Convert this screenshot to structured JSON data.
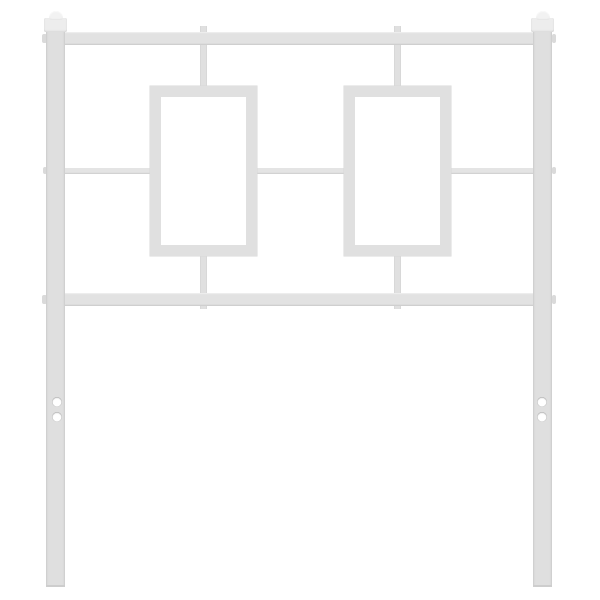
{
  "meta": {
    "description": "White metal bed headboard with two vertical posts topped by square finials, a top and bottom horizontal rail, two rectangular frame ornaments linked by a thin center crossbar and vertical stubs, and legs with two mounting holes each, photographed on a plain white background"
  },
  "scene": {
    "canvas": {
      "width": 600,
      "height": 600,
      "background": "#ffffff"
    },
    "palette": {
      "post": "#dfdfdf",
      "rail": "#e2e2e2",
      "crossbar": "#e4e4e4",
      "rect-frame": "#e0e0e0",
      "stub": "#e0e0e0",
      "nub": "#dadada",
      "tick": "#d2d2d2",
      "cap-block": "#ededed",
      "cap-dome": "#f2f2f2",
      "hole": "#ffffff",
      "edge": "#cdcdcd"
    },
    "parts": [
      {
        "name": "stub-top-left",
        "type": "stub",
        "x": 200,
        "y": 26,
        "w": 7,
        "h": 64
      },
      {
        "name": "stub-top-right",
        "type": "stub",
        "x": 394,
        "y": 26,
        "w": 7,
        "h": 64
      },
      {
        "name": "stub-bottom-left",
        "type": "stub",
        "x": 200,
        "y": 252,
        "w": 7,
        "h": 57
      },
      {
        "name": "stub-bottom-right",
        "type": "stub",
        "x": 394,
        "y": 252,
        "w": 7,
        "h": 57
      },
      {
        "name": "weld-tick-left-frame-inner-left",
        "type": "tick",
        "x": 160.5,
        "y": 167,
        "w": 3,
        "h": 7.5
      },
      {
        "name": "weld-tick-left-frame-inner-right",
        "type": "tick",
        "x": 242.5,
        "y": 167,
        "w": 3,
        "h": 7.5
      },
      {
        "name": "weld-tick-right-frame-inner-left",
        "type": "tick",
        "x": 354.5,
        "y": 167,
        "w": 3,
        "h": 7.5
      },
      {
        "name": "weld-tick-right-frame-inner-right",
        "type": "tick",
        "x": 436.5,
        "y": 167,
        "w": 3,
        "h": 7.5
      },
      {
        "name": "nub-left-post-top-rail",
        "type": "nub",
        "x": 42,
        "y": 34,
        "w": 4.5,
        "h": 9
      },
      {
        "name": "nub-left-post-crossbar",
        "type": "nub",
        "x": 42.5,
        "y": 166.5,
        "w": 4,
        "h": 7.5
      },
      {
        "name": "nub-left-post-bottom-rail",
        "type": "nub",
        "x": 42,
        "y": 295,
        "w": 4.5,
        "h": 9
      },
      {
        "name": "nub-right-post-top-rail",
        "type": "nub",
        "x": 551.5,
        "y": 34,
        "w": 4.5,
        "h": 9
      },
      {
        "name": "nub-right-post-crossbar",
        "type": "nub",
        "x": 552,
        "y": 166.5,
        "w": 4,
        "h": 7.5
      },
      {
        "name": "nub-right-post-bottom-rail",
        "type": "nub",
        "x": 551.5,
        "y": 295,
        "w": 4.5,
        "h": 9
      },
      {
        "name": "crossbar-left-segment",
        "type": "crossbar",
        "x": 62,
        "y": 167.5,
        "w": 92,
        "h": 6
      },
      {
        "name": "crossbar-middle-segment",
        "type": "crossbar",
        "x": 253,
        "y": 167.5,
        "w": 94,
        "h": 6
      },
      {
        "name": "crossbar-right-segment",
        "type": "crossbar",
        "x": 447,
        "y": 167.5,
        "w": 92,
        "h": 6
      },
      {
        "name": "left-ornament-frame",
        "type": "rect-frame",
        "x": 150,
        "y": 86,
        "w": 107,
        "h": 170
      },
      {
        "name": "right-ornament-frame",
        "type": "rect-frame",
        "x": 344,
        "y": 86,
        "w": 107,
        "h": 170
      },
      {
        "name": "top-rail",
        "type": "rail",
        "x": 58,
        "y": 32,
        "w": 484,
        "h": 13
      },
      {
        "name": "bottom-rail",
        "type": "rail",
        "x": 58,
        "y": 293,
        "w": 484,
        "h": 13
      },
      {
        "name": "left-post",
        "type": "post",
        "x": 46,
        "y": 28,
        "w": 19,
        "h": 559
      },
      {
        "name": "right-post",
        "type": "post",
        "x": 533,
        "y": 28,
        "w": 19,
        "h": 559
      },
      {
        "name": "left-leg-bottom-edge",
        "type": "edge",
        "x": 46,
        "y": 585,
        "w": 19,
        "h": 2
      },
      {
        "name": "right-leg-bottom-edge",
        "type": "edge",
        "x": 533,
        "y": 585,
        "w": 19,
        "h": 2
      },
      {
        "name": "left-finial-block",
        "type": "cap-block",
        "x": 44,
        "y": 18,
        "w": 23,
        "h": 14
      },
      {
        "name": "left-finial-dome",
        "type": "cap-dome",
        "x": 48.5,
        "y": 11,
        "w": 14,
        "h": 9
      },
      {
        "name": "right-finial-block",
        "type": "cap-block",
        "x": 531,
        "y": 18,
        "w": 23,
        "h": 14
      },
      {
        "name": "right-finial-dome",
        "type": "cap-dome",
        "x": 535.5,
        "y": 11,
        "w": 14,
        "h": 9
      },
      {
        "name": "mounting-hole-left-leg-upper",
        "type": "hole",
        "x": 51.5,
        "y": 396.5,
        "w": 10,
        "h": 10
      },
      {
        "name": "mounting-hole-left-leg-lower",
        "type": "hole",
        "x": 51.5,
        "y": 411.5,
        "w": 10,
        "h": 10
      },
      {
        "name": "mounting-hole-right-leg-upper",
        "type": "hole",
        "x": 537,
        "y": 396.5,
        "w": 10,
        "h": 10
      },
      {
        "name": "mounting-hole-right-leg-lower",
        "type": "hole",
        "x": 537,
        "y": 411.5,
        "w": 10,
        "h": 10
      }
    ]
  }
}
